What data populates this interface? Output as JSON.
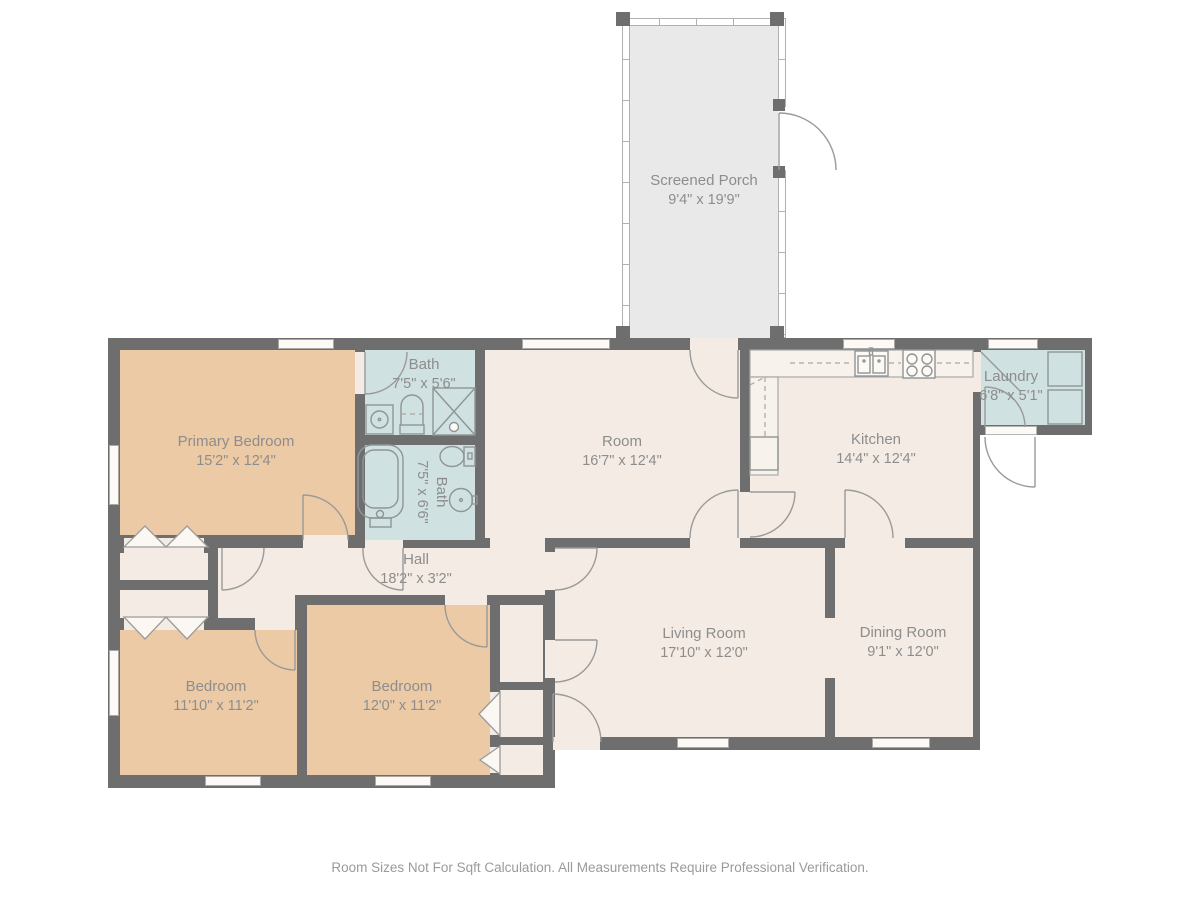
{
  "rooms": {
    "screened_porch": {
      "name": "Screened Porch",
      "dims": "9'4\" x 19'9\""
    },
    "primary_bedroom": {
      "name": "Primary Bedroom",
      "dims": "15'2\" x 12'4\""
    },
    "bath_upper": {
      "name": "Bath",
      "dims": "7'5\" x 5'6\""
    },
    "bath_lower": {
      "name": "Bath",
      "dims": "7'5\" x 6'6\""
    },
    "room": {
      "name": "Room",
      "dims": "16'7\" x 12'4\""
    },
    "kitchen": {
      "name": "Kitchen",
      "dims": "14'4\" x 12'4\""
    },
    "laundry": {
      "name": "Laundry",
      "dims": "6'8\" x 5'1\""
    },
    "hall": {
      "name": "Hall",
      "dims": "18'2\" x 3'2\""
    },
    "bedroom_left": {
      "name": "Bedroom",
      "dims": "11'10\" x 11'2\""
    },
    "bedroom_middle": {
      "name": "Bedroom",
      "dims": "12'0\" x 11'2\""
    },
    "living_room": {
      "name": "Living Room",
      "dims": "17'10\" x 12'0\""
    },
    "dining_room": {
      "name": "Dining Room",
      "dims": "9'1\" x 12'0\""
    }
  },
  "footer": {
    "disclaimer": "Room Sizes Not For Sqft Calculation. All Measurements Require Professional Verification."
  },
  "colors": {
    "wall": "#6e6e6e",
    "room_cream": "#f4ece4",
    "bedroom_tan": "#eccaa5",
    "wet_room_blue": "#cfe1e1",
    "porch_gray": "#e9e9e9",
    "label_gray": "#8d8d8d"
  },
  "fixtures": [
    "bathtub-icon",
    "toilet-icon",
    "round-sink-icon",
    "shower-icon",
    "vanity-sink-icon",
    "kitchen-sink-icon",
    "stove-icon",
    "washer-icon",
    "dryer-icon",
    "door-swing-arc",
    "bifold-door-icon",
    "window",
    "screen-wall"
  ]
}
